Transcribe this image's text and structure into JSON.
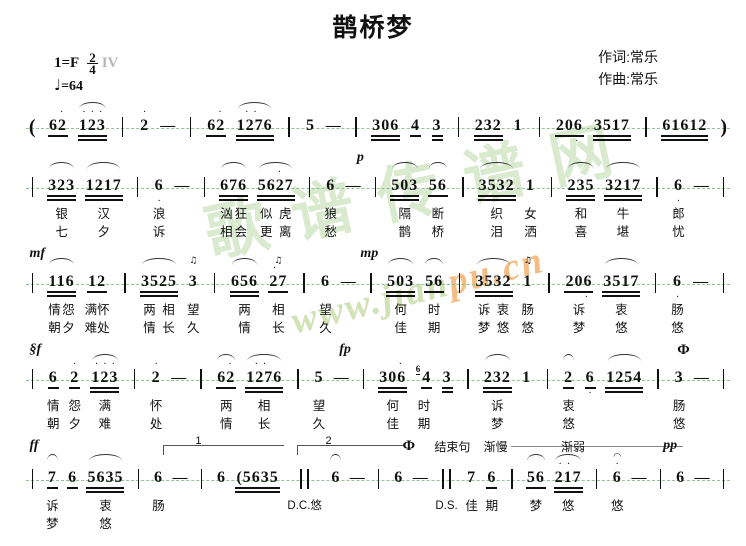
{
  "title": "鹊桥梦",
  "credits": {
    "lyricist": "作词:常乐",
    "composer": "作曲:常乐"
  },
  "header": {
    "key": "1=F",
    "time_top": "2",
    "time_bottom": "4",
    "artifact": "IV",
    "tempo_note": "♩",
    "tempo_value": "=64"
  },
  "watermark": {
    "cn": "歌谱传谱网",
    "url_left": "www.jian",
    "url_right": "pu.cn",
    "color_cn": "#9cca84",
    "color_url_left": "#c2d9a0",
    "color_url_right": "#f0a85c"
  },
  "colors": {
    "notation": "#111111",
    "guide_line": "#8ab98a",
    "mark_line": "#888888"
  },
  "systems": [
    {
      "cls": "sys-pad0",
      "lyrics": false,
      "marks": [],
      "voltas": [],
      "columns": [
        {
          "k": "paren",
          "t": "("
        },
        {
          "k": "note",
          "t": "62",
          "u": 1,
          "da": " ."
        },
        {
          "k": "note",
          "t": "123",
          "u": 2,
          "da": "...",
          "arc": true
        },
        {
          "k": "bar"
        },
        {
          "k": "note",
          "t": "2",
          "da": "."
        },
        {
          "k": "dash"
        },
        {
          "k": "bar"
        },
        {
          "k": "note",
          "t": "62",
          "u": 1,
          "da": " ."
        },
        {
          "k": "note",
          "t": "1276",
          "u": 2,
          "da": ".. ",
          "arc": true
        },
        {
          "k": "bar"
        },
        {
          "k": "note",
          "t": "5"
        },
        {
          "k": "dash"
        },
        {
          "k": "bar"
        },
        {
          "k": "note",
          "t": "306",
          "u": 2
        },
        {
          "k": "note",
          "t": "4",
          "u": 1
        },
        {
          "k": "note",
          "t": "3",
          "u": 2
        },
        {
          "k": "bar"
        },
        {
          "k": "note",
          "t": "232",
          "u": 2
        },
        {
          "k": "note",
          "t": "1"
        },
        {
          "k": "bar"
        },
        {
          "k": "note",
          "t": "206",
          "u": 1,
          "db": "  ."
        },
        {
          "k": "note",
          "t": "3517",
          "u": 2,
          "db": "   ."
        },
        {
          "k": "bar"
        },
        {
          "k": "note",
          "t": "61612",
          "u": 2,
          "db": ". .  "
        },
        {
          "k": "paren",
          "t": ")"
        }
      ]
    },
    {
      "cls": "sys-pad1",
      "lyrics": true,
      "marks": [
        {
          "t": "p",
          "x": "47%",
          "cls": "dyn"
        }
      ],
      "voltas": [],
      "columns": [
        {
          "k": "bar"
        },
        {
          "k": "note",
          "t": "323",
          "u": 2,
          "arc": true,
          "l1": "银",
          "l2": "七"
        },
        {
          "k": "note",
          "t": "1217",
          "u": 2,
          "arc": true,
          "db": "   .",
          "l1": "汉",
          "l2": "夕"
        },
        {
          "k": "bar"
        },
        {
          "k": "note",
          "t": "6",
          "db": ".",
          "l1": "浪",
          "l2": "诉"
        },
        {
          "k": "dash"
        },
        {
          "k": "bar"
        },
        {
          "k": "note",
          "t": "676",
          "u": 2,
          "arc": true,
          "l1": "汹狂",
          "l2": "相会"
        },
        {
          "k": "note",
          "t": "5627",
          "u": 2,
          "arc": true,
          "da": "  . ",
          "l1": "似虎",
          "l2": "更离"
        },
        {
          "k": "bar"
        },
        {
          "k": "note",
          "t": "6",
          "l1": "狼",
          "l2": "愁"
        },
        {
          "k": "dash"
        },
        {
          "k": "bar"
        },
        {
          "k": "note",
          "t": "503",
          "u": 2,
          "arc": true,
          "l1": "隔",
          "l2": "鹊"
        },
        {
          "k": "note",
          "t": "56",
          "u": 1,
          "arc": true,
          "l1": "断",
          "l2": "桥"
        },
        {
          "k": "bar"
        },
        {
          "k": "note",
          "t": "3532",
          "u": 2,
          "arc": true,
          "l1": "织",
          "l2": "泪"
        },
        {
          "k": "note",
          "t": "1",
          "l1": "女",
          "l2": "洒"
        },
        {
          "k": "bar"
        },
        {
          "k": "note",
          "t": "235",
          "u": 2,
          "arc": true,
          "l1": "和",
          "l2": "喜"
        },
        {
          "k": "note",
          "t": "3217",
          "u": 2,
          "arc": true,
          "db": "   .",
          "l1": "牛",
          "l2": "堪"
        },
        {
          "k": "bar"
        },
        {
          "k": "note",
          "t": "6",
          "db": ".",
          "l1": "郎",
          "l2": "忧"
        },
        {
          "k": "dash"
        },
        {
          "k": "bar"
        }
      ]
    },
    {
      "cls": "sys-pad1",
      "lyrics": true,
      "marks": [
        {
          "t": "mf",
          "x": "0.5%",
          "cls": "dyn"
        },
        {
          "t": "mp",
          "x": "47.5%",
          "cls": "dyn"
        }
      ],
      "voltas": [],
      "columns": [
        {
          "k": "bar"
        },
        {
          "k": "note",
          "t": "116",
          "u": 2,
          "arc": true,
          "l1": "情怨",
          "l2": "朝夕"
        },
        {
          "k": "note",
          "t": "12",
          "u": 1,
          "l1": "满怀",
          "l2": "难处"
        },
        {
          "k": "bar"
        },
        {
          "k": "note",
          "t": "3525",
          "u": 2,
          "arc": true,
          "l1": "两相",
          "l2": "情长"
        },
        {
          "k": "note",
          "t": "3",
          "orn": "♫",
          "l1": "望",
          "l2": "久"
        },
        {
          "k": "bar"
        },
        {
          "k": "note",
          "t": "656",
          "u": 2,
          "arc": true,
          "l1": "两",
          "l2": "情"
        },
        {
          "k": "note",
          "t": "27",
          "u": 1,
          "da": ". ",
          "orn": "♫",
          "l1": "相",
          "l2": "长"
        },
        {
          "k": "bar"
        },
        {
          "k": "note",
          "t": "6",
          "l1": "望",
          "l2": "久"
        },
        {
          "k": "dash"
        },
        {
          "k": "bar"
        },
        {
          "k": "note",
          "t": "503",
          "u": 2,
          "arc": true,
          "l1": "何",
          "l2": "佳"
        },
        {
          "k": "note",
          "t": "56",
          "u": 1,
          "arc": true,
          "l1": "时",
          "l2": "期"
        },
        {
          "k": "bar"
        },
        {
          "k": "note",
          "t": "3532",
          "u": 2,
          "arc": true,
          "l1": "诉衷",
          "l2": "梦悠"
        },
        {
          "k": "note",
          "t": "1",
          "orn": "♫",
          "l1": "肠",
          "l2": "悠"
        },
        {
          "k": "bar"
        },
        {
          "k": "note",
          "t": "206",
          "u": 1,
          "db": "  .",
          "l1": "诉",
          "l2": "梦"
        },
        {
          "k": "note",
          "t": "3517",
          "u": 2,
          "arc": true,
          "db": " . .",
          "l1": "衷",
          "l2": "悠"
        },
        {
          "k": "bar"
        },
        {
          "k": "note",
          "t": "6",
          "db": ".",
          "l1": "肠",
          "l2": "悠"
        },
        {
          "k": "dash"
        },
        {
          "k": "bar"
        }
      ]
    },
    {
      "cls": "sys-pad1",
      "lyrics": true,
      "marks": [
        {
          "t": "§f",
          "x": "0.5%",
          "cls": "dyn"
        },
        {
          "t": "fp",
          "x": "44.5%",
          "cls": "dyn"
        },
        {
          "t": "Φ",
          "x": "92.5%",
          "cls": "coda"
        }
      ],
      "voltas": [],
      "columns": [
        {
          "k": "bar"
        },
        {
          "k": "note",
          "t": "6",
          "u": 1,
          "l1": "情",
          "l2": "朝"
        },
        {
          "k": "note",
          "t": "2",
          "u": 1,
          "da": ".",
          "l1": "怨",
          "l2": "夕"
        },
        {
          "k": "note",
          "t": "123",
          "u": 2,
          "da": "...",
          "arc": true,
          "l1": "满",
          "l2": "难"
        },
        {
          "k": "bar"
        },
        {
          "k": "note",
          "t": "2",
          "da": ".",
          "l1": "怀",
          "l2": "处"
        },
        {
          "k": "dash"
        },
        {
          "k": "bar"
        },
        {
          "k": "note",
          "t": "62",
          "u": 1,
          "da": " .",
          "arc": true,
          "l1": "两",
          "l2": "情"
        },
        {
          "k": "note",
          "t": "1276",
          "u": 2,
          "da": ".. ",
          "arc": true,
          "l1": "相",
          "l2": "长"
        },
        {
          "k": "bar"
        },
        {
          "k": "note",
          "t": "5",
          "l1": "望",
          "l2": "久"
        },
        {
          "k": "dash"
        },
        {
          "k": "bar"
        },
        {
          "k": "note",
          "t": "306",
          "u": 2,
          "da": "  .",
          "l1": "何",
          "l2": "佳"
        },
        {
          "k": "note",
          "t": "4",
          "u": 1,
          "sup": "6",
          "l1": "时",
          "l2": "期"
        },
        {
          "k": "note",
          "t": "3",
          "u": 2
        },
        {
          "k": "bar"
        },
        {
          "k": "note",
          "t": "232",
          "u": 2,
          "arc": true,
          "l1": "诉",
          "l2": "梦"
        },
        {
          "k": "note",
          "t": "1"
        },
        {
          "k": "bar"
        },
        {
          "k": "note",
          "t": "2",
          "u": 1,
          "arc": true,
          "l1": "衷",
          "l2": "悠"
        },
        {
          "k": "note",
          "t": "6",
          "u": 1,
          "db": "."
        },
        {
          "k": "note",
          "t": "1254",
          "u": 2,
          "arc": true
        },
        {
          "k": "bar"
        },
        {
          "k": "note",
          "t": "3",
          "l1": "肠",
          "l2": "悠"
        },
        {
          "k": "dash"
        },
        {
          "k": "bar"
        }
      ]
    },
    {
      "cls": "sys-pad2",
      "lyrics": true,
      "marks": [
        {
          "t": "ff",
          "x": "0.5%",
          "cls": "dyn"
        },
        {
          "t": "Φ",
          "x": "53.5%",
          "cls": "coda"
        },
        {
          "t": "结束句",
          "x": "58%",
          "cls": "cnmark"
        },
        {
          "t": "渐慢",
          "x": "65%",
          "cls": "cnmark",
          "line": "80px"
        },
        {
          "t": "渐弱",
          "x": "76%",
          "cls": "cnmark",
          "line": "95px"
        },
        {
          "t": "pp",
          "x": "90.5%",
          "cls": "dyn"
        }
      ],
      "voltas": [
        {
          "label": "1",
          "left": "19.5%",
          "width": "17%"
        },
        {
          "label": "2",
          "left": "38.5%",
          "width": "15%"
        }
      ],
      "columns": [
        {
          "k": "bar"
        },
        {
          "k": "note",
          "t": "7",
          "u": 1,
          "arc": true,
          "l1": "诉",
          "l2": "梦"
        },
        {
          "k": "note",
          "t": "6",
          "u": 1
        },
        {
          "k": "note",
          "t": "5635",
          "u": 2,
          "arc": true,
          "l1": "衷",
          "l2": "悠"
        },
        {
          "k": "bar"
        },
        {
          "k": "note",
          "t": "6",
          "l1": "肠"
        },
        {
          "k": "dash"
        },
        {
          "k": "bar"
        },
        {
          "k": "note",
          "t": "6"
        },
        {
          "k": "note",
          "t": "(5635",
          "u": 2
        },
        {
          "k": "dbar",
          "l1": "D.C.悠"
        },
        {
          "k": "note",
          "t": "6",
          "arc": true
        },
        {
          "k": "dash"
        },
        {
          "k": "bar"
        },
        {
          "k": "note",
          "t": "6"
        },
        {
          "k": "dash"
        },
        {
          "k": "dbar",
          "l1": "D.S."
        },
        {
          "k": "note",
          "t": "7",
          "l1": "佳"
        },
        {
          "k": "note",
          "t": "6",
          "u": 1,
          "l1": "期"
        },
        {
          "k": "bar"
        },
        {
          "k": "note",
          "t": "56",
          "u": 1,
          "arc": true,
          "l1": "梦"
        },
        {
          "k": "note",
          "t": "217",
          "u": 2,
          "da": ".. ",
          "arc": true,
          "l1": "悠"
        },
        {
          "k": "bar"
        },
        {
          "k": "note",
          "t": "6",
          "orn": "◠",
          "da": ".",
          "l1": "悠"
        },
        {
          "k": "dash"
        },
        {
          "k": "bar"
        },
        {
          "k": "note",
          "t": "6"
        },
        {
          "k": "dash"
        },
        {
          "k": "bar"
        }
      ]
    }
  ]
}
